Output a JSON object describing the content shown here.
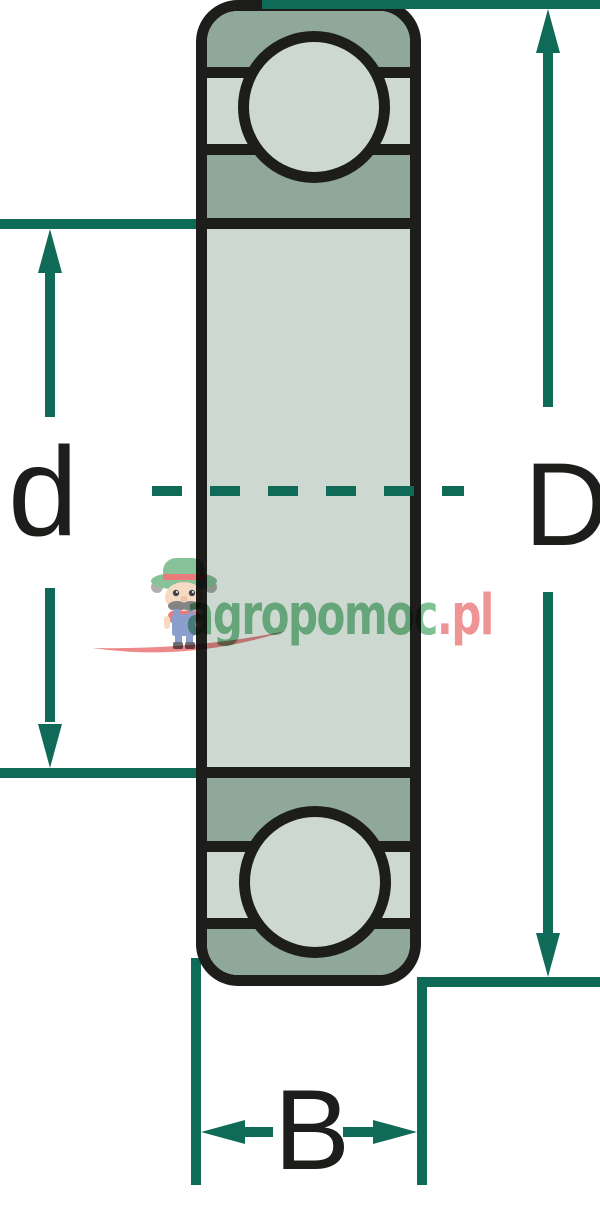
{
  "diagram": {
    "name": "ball-bearing-cross-section-dimensions",
    "dimension_labels": {
      "bore": "d",
      "outer_diameter": "D",
      "width": "B"
    },
    "colors": {
      "dimension_line": "#0f6a57",
      "outline": "#1d1d1b",
      "ring_dark": "#90a89a",
      "ring_light": "#cdd8d0",
      "background": "#ffffff"
    }
  },
  "watermark": {
    "brand_green": "agropomoc",
    "brand_red": ".pl",
    "colors": {
      "green": "#74bd8d",
      "red": "#ee8b8b"
    },
    "mascot": "farmer-mascot"
  }
}
